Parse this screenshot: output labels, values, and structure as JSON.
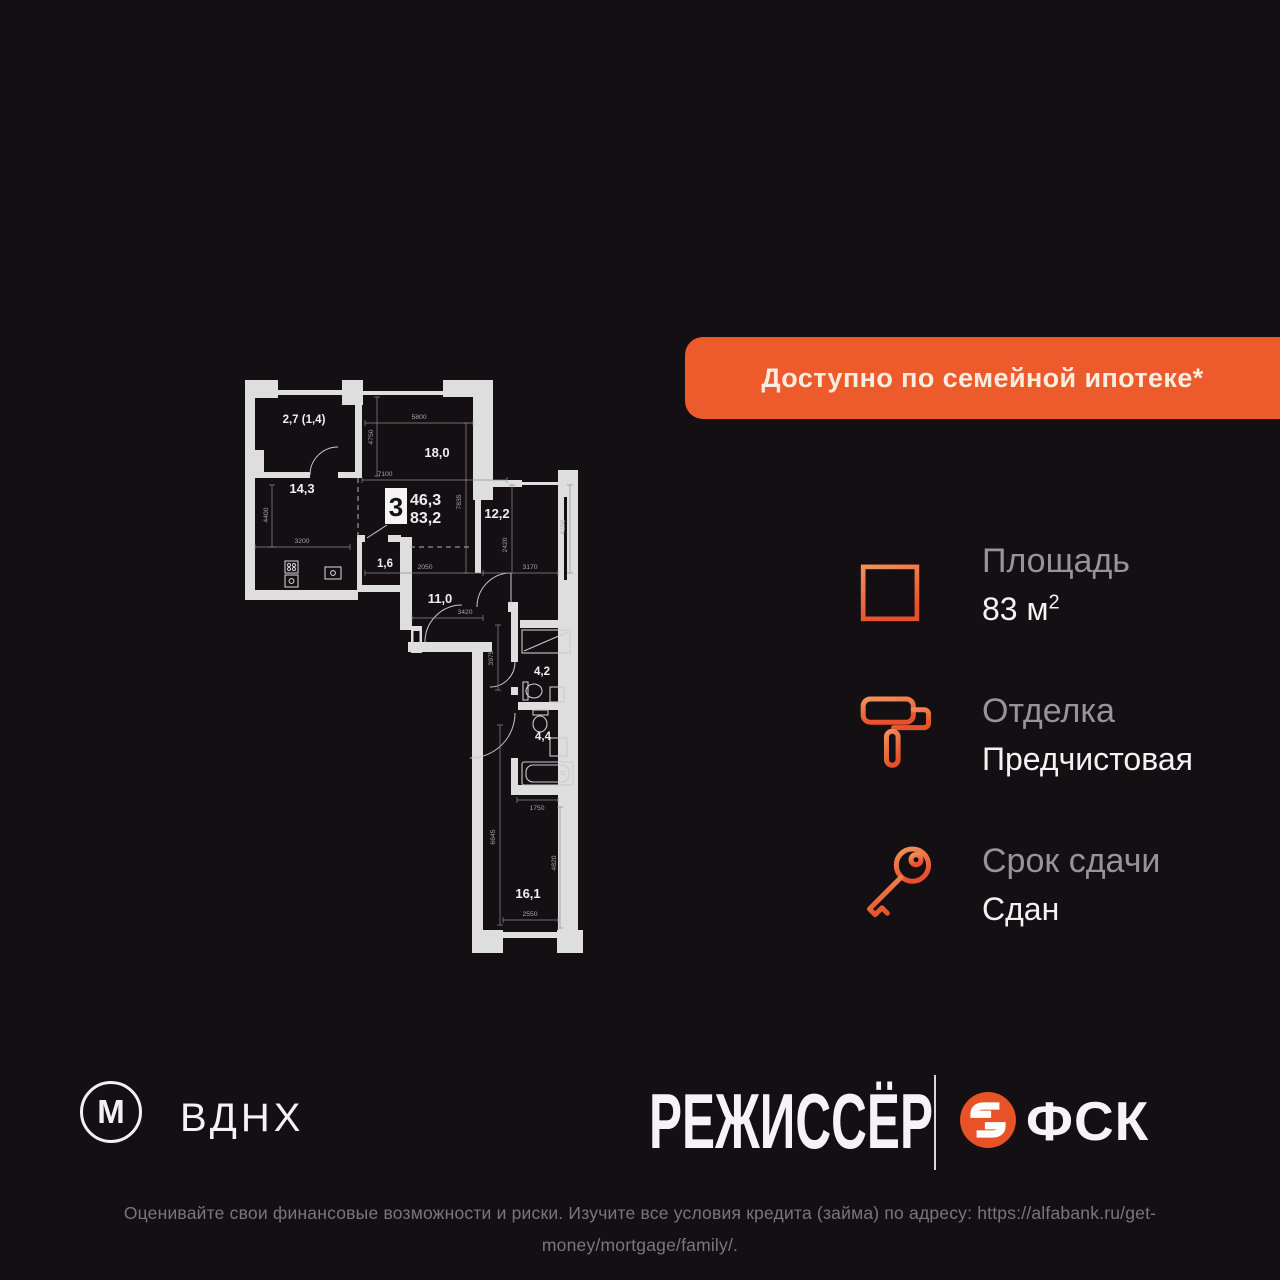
{
  "banner": {
    "label": "Доступно по семейной ипотеке*"
  },
  "plan": {
    "badge": {
      "rooms": "3",
      "living_area": "46,3",
      "total_area": "83,2"
    },
    "rooms": {
      "r1": "2,7 (1,4)",
      "r2": "14,3",
      "r3": "18,0",
      "r4": "12,2",
      "r5": "1,6",
      "r6": "11,0",
      "r7": "4,2",
      "r8": "4,4",
      "r9": "16,1"
    },
    "dims": {
      "d5800": "5800",
      "d4750": "4750",
      "d7100": "7100",
      "d7835": "7835",
      "d4400": "4400",
      "d3200": "3200",
      "d2050": "2050",
      "d3170": "3170",
      "d2420": "2420",
      "d4150": "4150",
      "d3420": "3420",
      "d3975": "3975",
      "d1750": "1750",
      "d6645": "6645",
      "d4820": "4820",
      "d2550": "2550"
    }
  },
  "info": {
    "area": {
      "label": "Площадь",
      "value": "83 м",
      "sup": "2"
    },
    "finish": {
      "label": "Отделка",
      "value": "Предчистовая"
    },
    "deadline": {
      "label": "Срок сдачи",
      "value": "Сдан"
    }
  },
  "footer": {
    "metro_letter": "М",
    "metro_station": "ВДНХ",
    "developer": "РЕЖИССЁР",
    "brand": "ФСК"
  },
  "disclaimer": "Оценивайте свои финансовые возможности и риски. Изучите все условия кредита (займа) по адресу: https://alfabank.ru/get-money/mortgage/family/.",
  "colors": {
    "accent": "#ED5A2B",
    "background": "#130F12"
  }
}
